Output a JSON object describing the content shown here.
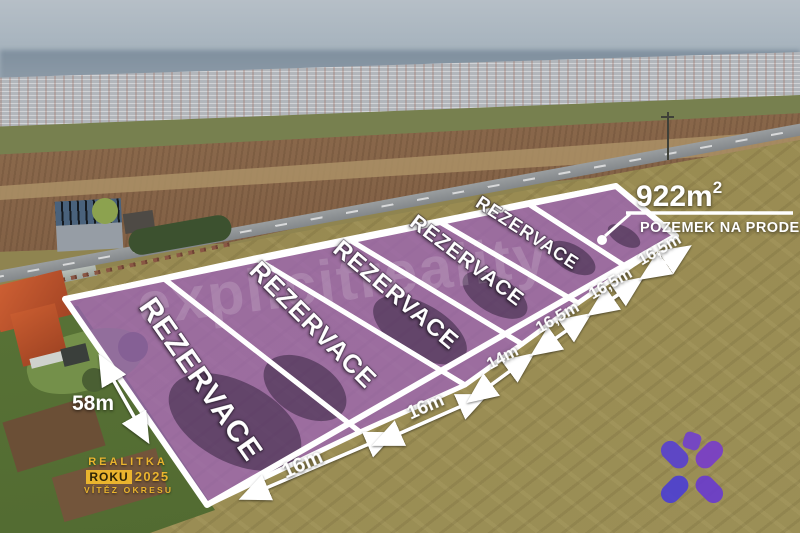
{
  "photo": {
    "description": "Aerial drone photo of a development: six land plots outlined in white with purple overlay between a road and farm fields, town and hills on the horizon, family houses with gardens at lower left"
  },
  "colors": {
    "plot_overlay": "#9c63b8",
    "plot_border": "#ffffff",
    "label_text": "#ffffff",
    "badge_gold": "#eab42e",
    "logo_purple_blue": "#5b44cb",
    "logo_purple_magenta": "#7c3fc4"
  },
  "listing": {
    "area_main": "922m",
    "area_sup": "2",
    "caption": "POZEMEK NA PRODEJ"
  },
  "plots": {
    "reserved_labels": [
      "REZERVACE",
      "REZERVACE",
      "REZERVACE",
      "REZERVACE",
      "REZERVACE"
    ]
  },
  "dimensions": {
    "left_side": "58m",
    "bottom": [
      "16m",
      "16m"
    ],
    "right_side": [
      "14m",
      "16,5m",
      "16,5m",
      "16,5m"
    ]
  },
  "badge": {
    "line1": "REALITKA",
    "box": "ROKU",
    "year": "2025",
    "line3": "VÍTĚZ OKRESU"
  },
  "watermark": {
    "text": "explicitreality"
  }
}
